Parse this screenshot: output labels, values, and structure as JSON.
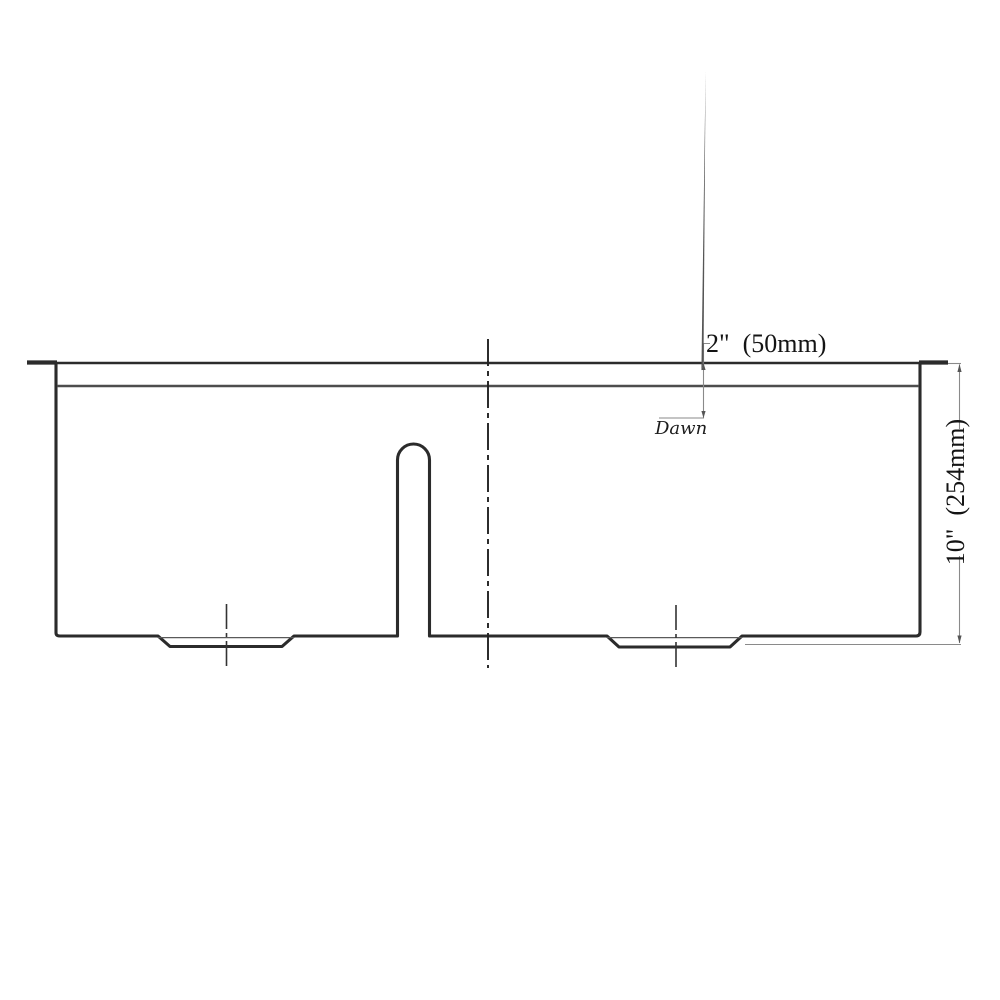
{
  "page": {
    "background": "#ffffff"
  },
  "drawing": {
    "subject": "double-bowl-sink-front-section",
    "brand_label": "Dawn",
    "labels": {
      "top_dim": "2\"  (50mm)",
      "side_dim": "10\"  (254mm)"
    },
    "colors": {
      "outline": "#2b2b2b",
      "rim_line": "#4d4d4d",
      "thin_detail": "#5a5a5a",
      "dimension_line": "#8a8a8a",
      "centerline": "#222222",
      "arrow": "#555555",
      "text": "#141414"
    }
  }
}
